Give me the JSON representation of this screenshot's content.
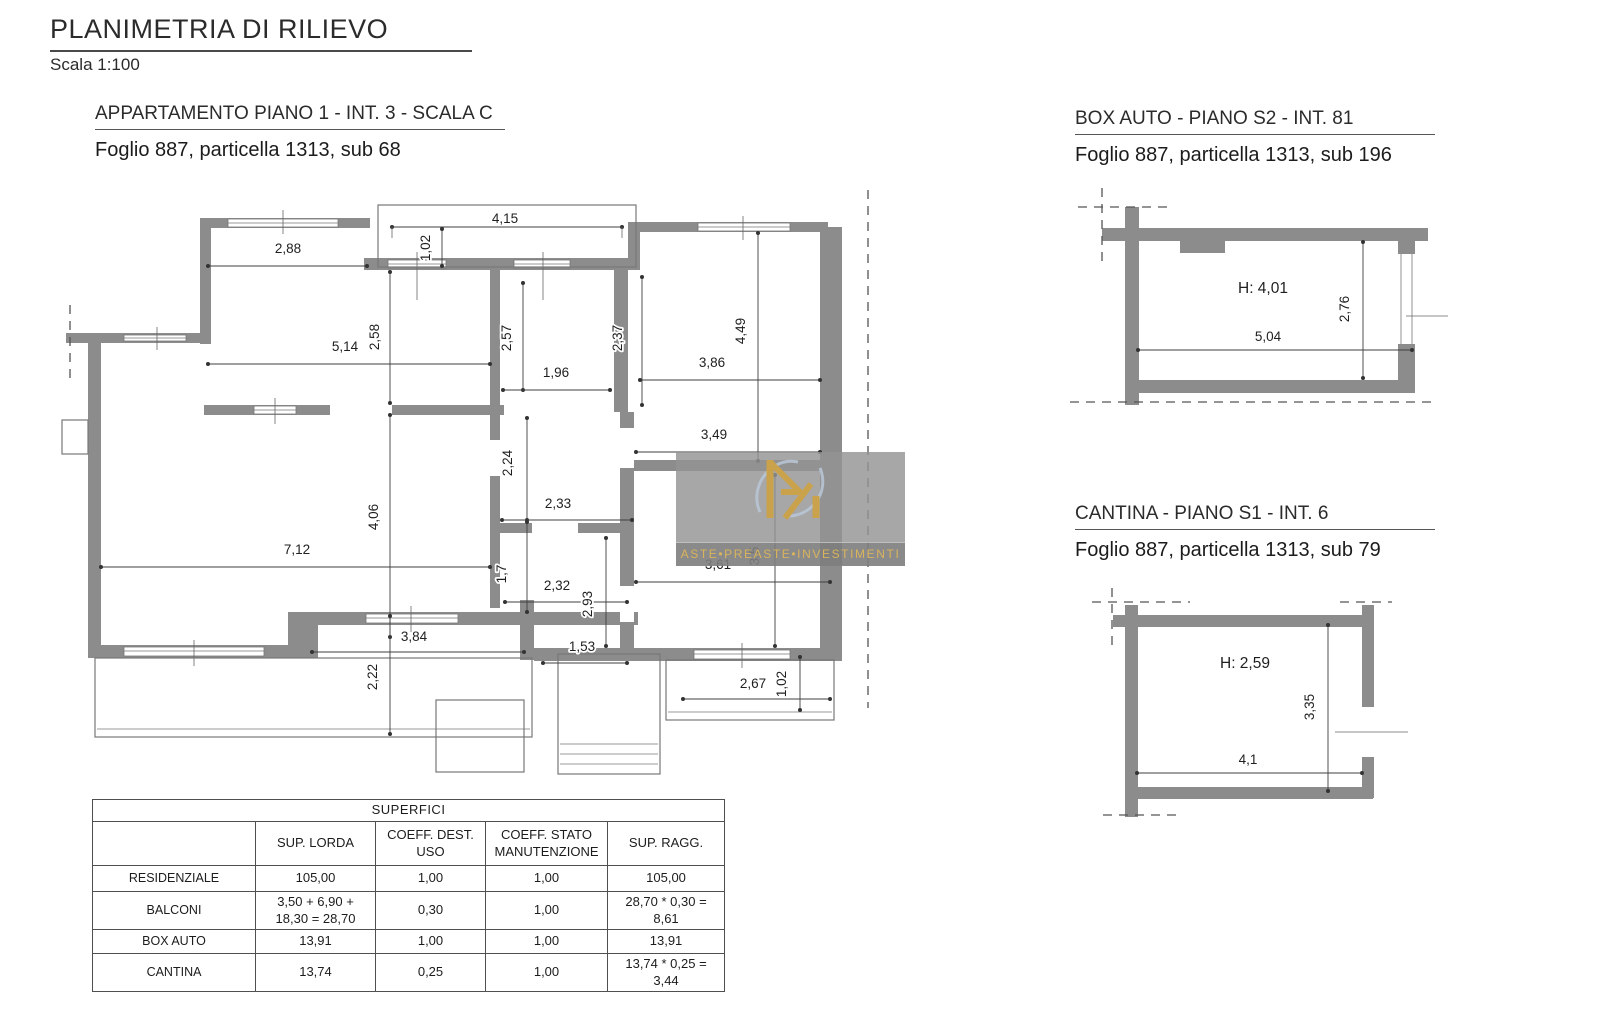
{
  "page": {
    "title": "PLANIMETRIA DI RILIEVO",
    "scale": "Scala 1:100"
  },
  "watermark": {
    "text": "ASTE•PREASTE•INVESTIMENTI"
  },
  "apartment": {
    "title": "APPARTAMENTO PIANO 1 - INT. 3 - SCALA C",
    "subtitle": "Foglio 887, particella 1313, sub 68",
    "dims": {
      "d1": "2,88",
      "d2": "4,15",
      "d3": "1,02",
      "d4": "5,14",
      "d5": "2,58",
      "d6": "2,57",
      "d7": "1,96",
      "d8": "2,37",
      "d9": "3,86",
      "d10": "4,49",
      "d11": "3,49",
      "d12": "2,24",
      "d13": "2,33",
      "d14": "4,06",
      "d15": "7,12",
      "d16": "1,7",
      "d17": "2,32",
      "d18": "2,93",
      "d19": "3,61",
      "d20": "3,5",
      "d21": "3,84",
      "d22": "1,53",
      "d23": "2,22",
      "d24": "2,67",
      "d25": "1,02"
    }
  },
  "box_auto": {
    "title": "BOX AUTO - PIANO S2 - INT. 81",
    "subtitle": "Foglio 887, particella 1313, sub 196",
    "dims": {
      "height": "H: 4,01",
      "depth": "2,76",
      "width": "5,04"
    }
  },
  "cantina": {
    "title": "CANTINA - PIANO S1 - INT. 6",
    "subtitle": "Foglio 887, particella 1313, sub 79",
    "dims": {
      "height": "H: 2,59",
      "depth": "3,35",
      "width": "4,1"
    }
  },
  "table": {
    "title": "SUPERFICI",
    "headers": [
      "",
      "SUP. LORDA",
      "COEFF. DEST. USO",
      "COEFF. STATO MANUTENZIONE",
      "SUP. RAGG."
    ],
    "rows": [
      [
        "RESIDENZIALE",
        "105,00",
        "1,00",
        "1,00",
        "105,00"
      ],
      [
        "BALCONI",
        "3,50 + 6,90 + 18,30 = 28,70",
        "0,30",
        "1,00",
        "28,70 * 0,30 = 8,61"
      ],
      [
        "BOX AUTO",
        "13,91",
        "1,00",
        "1,00",
        "13,91"
      ],
      [
        "CANTINA",
        "13,74",
        "0,25",
        "1,00",
        "13,74 * 0,25 = 3,44"
      ]
    ]
  },
  "colors": {
    "wall": "#8c8c8c",
    "gold": "#c9a24b",
    "dash": "#555555"
  }
}
